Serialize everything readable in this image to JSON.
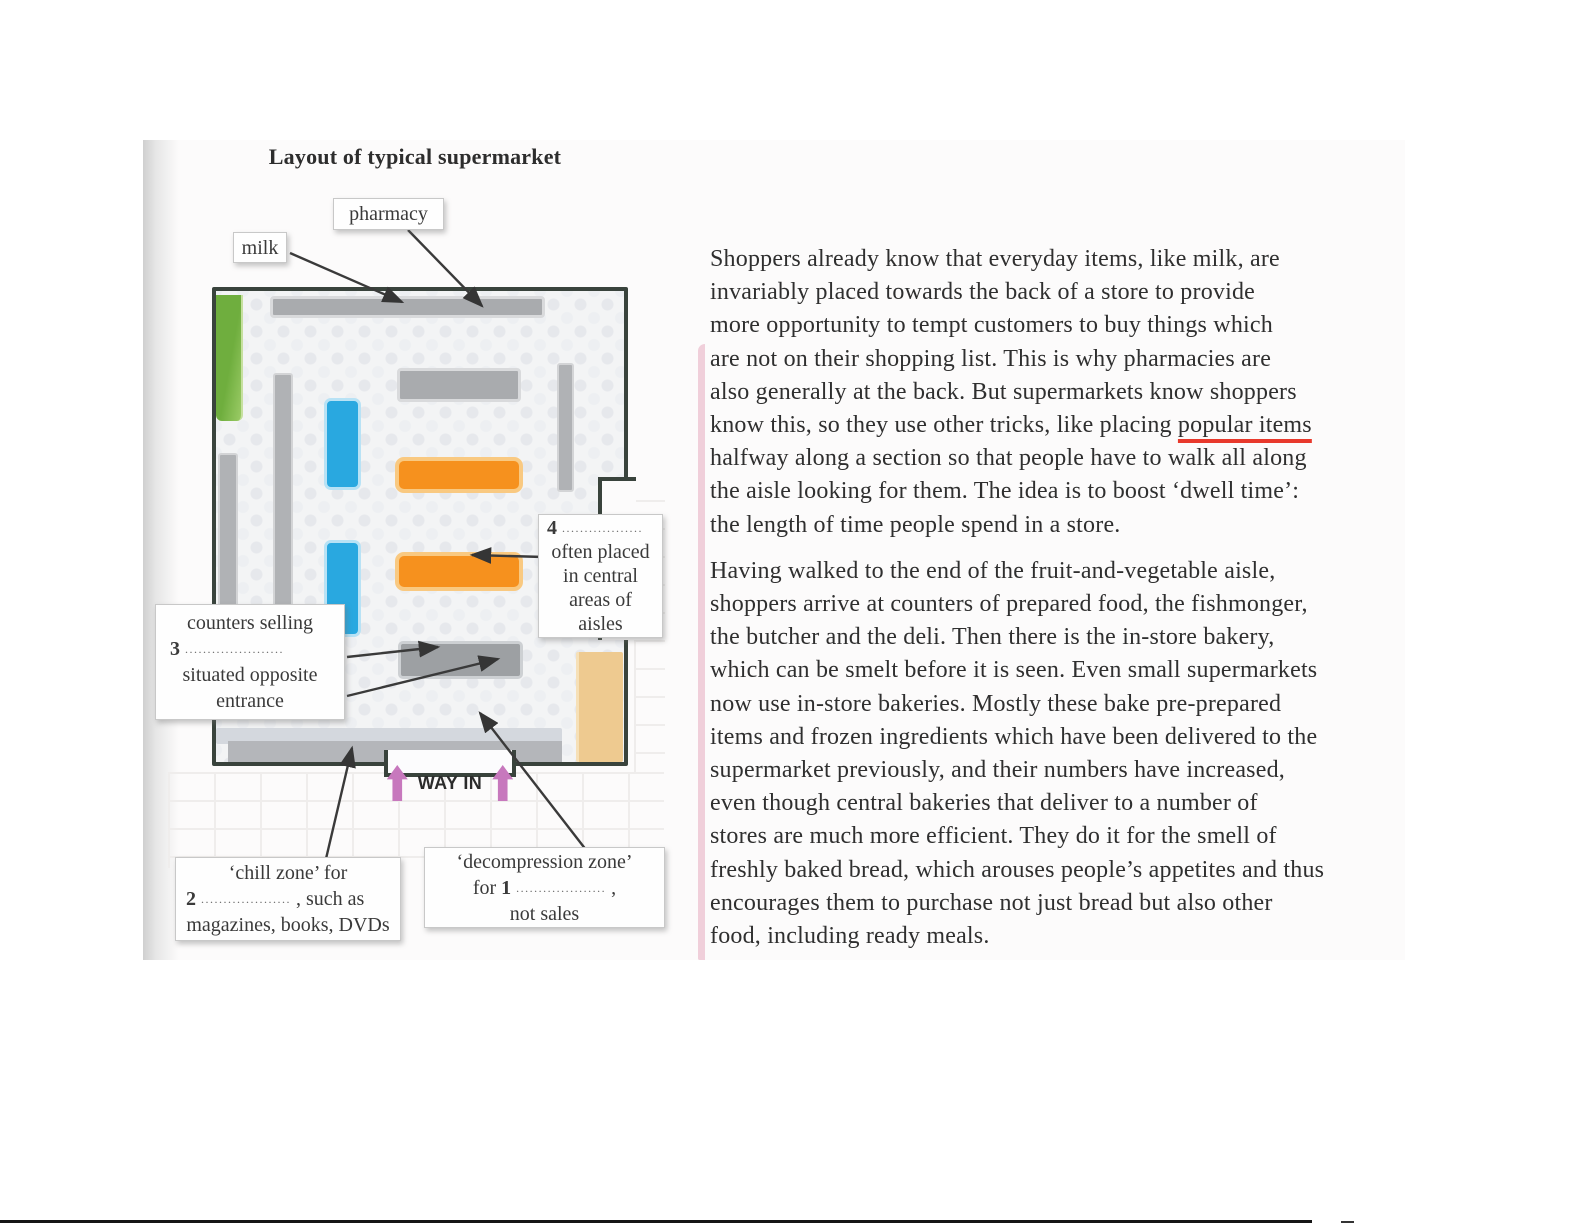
{
  "diagram": {
    "title": "Layout of typical supermarket",
    "way_in": "WAY IN",
    "labels": {
      "milk": {
        "lines": [
          "milk"
        ]
      },
      "pharmacy": {
        "lines": [
          "pharmacy"
        ]
      },
      "counters": {
        "lines": [
          "counters selling",
          "**3** ......................",
          "situated opposite",
          "entrance"
        ]
      },
      "central_aisles": {
        "lines": [
          "**4** ..................",
          "often placed",
          "in central",
          "areas of",
          "aisles"
        ]
      },
      "chill_zone": {
        "lines": [
          "‘chill zone’ for",
          "**2** .................... , such as",
          "magazines, books, DVDs"
        ]
      },
      "decompression_zone": {
        "lines": [
          "‘decompression zone’",
          "for **1** .................... ,",
          "not sales"
        ]
      }
    }
  },
  "passage": {
    "paragraphs": [
      {
        "lines": [
          "Shoppers already know that everyday items, like milk, are",
          "invariably placed towards the back of a store to provide",
          "more opportunity to tempt customers to buy things which",
          "are not on their shopping list. This is why pharmacies are",
          "also generally at the back. But supermarkets know shoppers",
          "know this, so they use other tricks, like placing ~~popular items~~",
          "halfway along a section so that people have to walk all along",
          "the aisle looking for them. The idea is to boost ‘dwell time’:",
          "the length of time people spend in a store."
        ]
      },
      {
        "lines": [
          "Having walked to the end of the fruit-and-vegetable aisle,",
          "shoppers arrive at counters of prepared food, the fishmonger,",
          "the butcher and the deli. Then there is the in-store bakery,",
          "which can be smelt before it is seen. Even small supermarkets",
          "now use in-store bakeries. Mostly these bake pre-prepared",
          "items and frozen ingredients which have been delivered to the",
          "supermarket previously, and their numbers have increased,",
          "even though central bakeries that deliver to a number of",
          "stores are much more efficient. They do it for the smell of",
          "freshly baked bread, which arouses people’s appetites and thus",
          "encourages them to purchase not just bread but also other",
          "food, including ready meals."
        ]
      }
    ]
  },
  "colors": {
    "wall": "#39433c",
    "green_a": "#6fae3e",
    "green_b": "#9bcb66",
    "blue": "#29a8e0",
    "blue_border": "#b8e2f5",
    "orange": "#f6911e",
    "orange_border": "#f9c981",
    "gray_shelf": "#a9abae",
    "gray_shelf_border": "#d9dadc",
    "tan": "#eeca90",
    "pink_arrow": "#c778bd",
    "red_underline": "#e8392c"
  }
}
